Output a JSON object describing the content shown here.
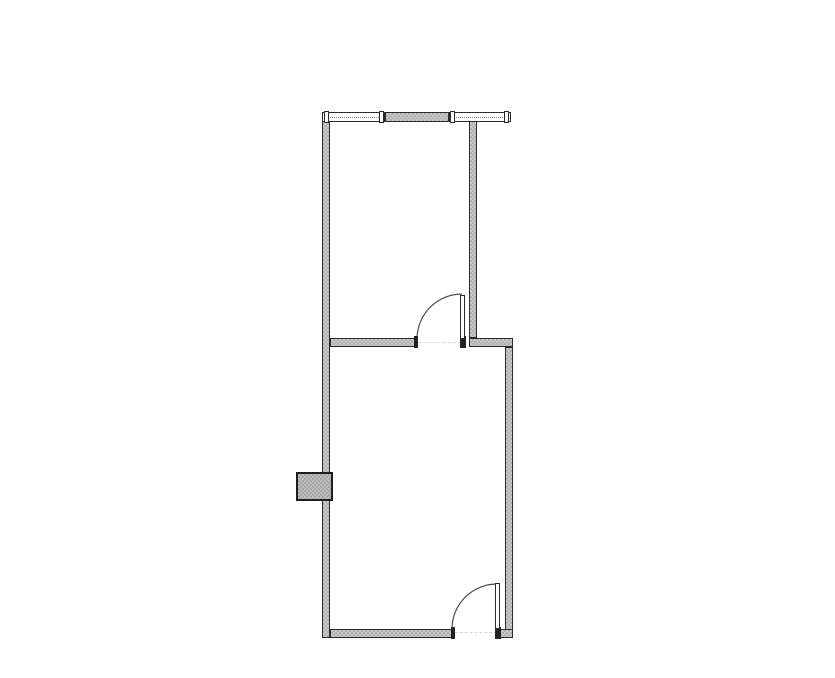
{
  "canvas": {
    "width": 835,
    "height": 678,
    "background": "#ffffff"
  },
  "palette": {
    "bg": "#ffffff",
    "wall_fill": "#c8c8c8",
    "wall_stipple": "#b2b2b2",
    "wall_border": "#2b2b2b",
    "window_fill": "#ffffff",
    "window_line": "#8a8a8a",
    "leaf_fill": "#ffffff",
    "jamb_fill": "#222222",
    "threshold": "#d8d8d8",
    "arc_stroke": "#4d4d4d",
    "fixture_fill": "#bdbdbd",
    "fixture_stipple": "#a6a6a6",
    "fixture_border": "#1d1d1d"
  },
  "walls": {
    "left": {
      "x": 322,
      "y": 112,
      "w": 8,
      "h": 526
    },
    "top_middle": {
      "x": 385,
      "y": 112,
      "w": 64,
      "h": 10
    },
    "upper_right": {
      "x": 469,
      "y": 121,
      "w": 8,
      "h": 217
    },
    "middle_left": {
      "x": 330,
      "y": 338,
      "w": 88,
      "h": 9
    },
    "middle_right": {
      "x": 469,
      "y": 338,
      "w": 44,
      "h": 9
    },
    "lower_right": {
      "x": 505,
      "y": 347,
      "w": 8,
      "h": 291
    },
    "bottom_left": {
      "x": 330,
      "y": 629,
      "w": 125,
      "h": 9
    },
    "bottom_right": {
      "x": 497,
      "y": 629,
      "w": 16,
      "h": 9
    }
  },
  "windows": {
    "left": {
      "x": 322,
      "y": 112,
      "w": 63,
      "h": 10
    },
    "right": {
      "x": 449,
      "y": 112,
      "w": 62,
      "h": 10
    },
    "caps": [
      {
        "x": 324,
        "y": 111,
        "w": 5,
        "h": 12
      },
      {
        "x": 379,
        "y": 111,
        "w": 5,
        "h": 12
      },
      {
        "x": 450,
        "y": 111,
        "w": 5,
        "h": 12
      },
      {
        "x": 504,
        "y": 111,
        "w": 5,
        "h": 12
      }
    ]
  },
  "doors": {
    "middle": {
      "leaf": {
        "x": 460,
        "y": 295,
        "w": 5,
        "h": 44
      },
      "arc_path": "M 417 339 A 45 45 0 0 1 462 294",
      "threshold": {
        "x": 418,
        "y": 342,
        "w": 43,
        "h": 1
      },
      "jamb_left": {
        "x": 414,
        "y": 336,
        "w": 4,
        "h": 12
      },
      "jamb_right": {
        "x": 460,
        "y": 336,
        "w": 6,
        "h": 12
      }
    },
    "bottom": {
      "leaf": {
        "x": 495,
        "y": 583,
        "w": 5,
        "h": 46
      },
      "arc_path": "M 452 629 A 45 45 0 0 1 497 584",
      "threshold": {
        "x": 455,
        "y": 632,
        "w": 42,
        "h": 1
      },
      "jamb_left": {
        "x": 451,
        "y": 627,
        "w": 4,
        "h": 12
      },
      "jamb_right": {
        "x": 495,
        "y": 627,
        "w": 6,
        "h": 12
      }
    }
  },
  "fixture": {
    "x": 296,
    "y": 472,
    "w": 37,
    "h": 29
  }
}
